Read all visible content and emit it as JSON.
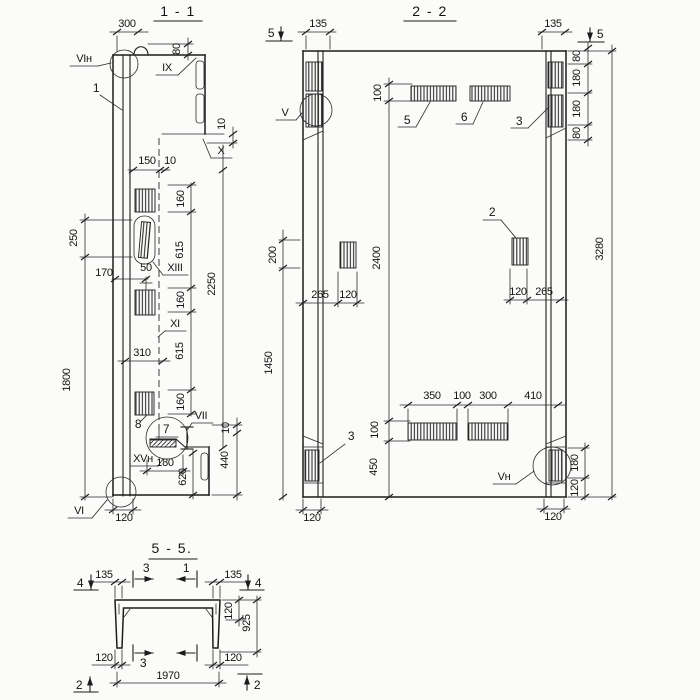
{
  "drawing": {
    "kind": "structural panel sections blueprint",
    "ink": "#1c1c1c",
    "paper": "#fbfbf9"
  },
  "s11": {
    "title": "1 - 1",
    "d300": "300",
    "d80": "80",
    "lblVIn": "VIн",
    "lblIX": "IX",
    "c1": "1",
    "d10tr": "10",
    "lblX": "X",
    "d150": "150",
    "d10t": "10",
    "d160a": "160",
    "d615a": "615",
    "lblXIII": "XIII",
    "d170": "170",
    "d50": "50",
    "d250": "250",
    "d160b": "160",
    "lblXI": "XI",
    "d615b": "615",
    "d310": "310",
    "d2250": "2250",
    "d1800": "1800",
    "d160c": "160",
    "c8": "8",
    "c7": "7",
    "lblVII": "VII",
    "d10br": "10",
    "d440": "440",
    "lblXVn": "XVн",
    "d180": "180",
    "d620": "620",
    "lblVI": "VI",
    "d120": "120"
  },
  "s22": {
    "title": "2 - 2",
    "m5l": "5",
    "d135l": "135",
    "lblV": "V",
    "d100t": "100",
    "c5": "5",
    "c6": "6",
    "c3t": "3",
    "d135r": "135",
    "m5r": "5",
    "d80a": "80",
    "d180a": "180",
    "d180b": "180",
    "d80b": "80",
    "d200": "200",
    "d1450": "1450",
    "d2400": "2400",
    "d3280": "3280",
    "c2": "2",
    "d265l": "265",
    "d120l": "120",
    "d120r": "120",
    "d265r": "265",
    "d350": "350",
    "d100m": "100",
    "d300": "300",
    "d410": "410",
    "d100b": "100",
    "d450": "450",
    "c3b": "3",
    "lblVn": "Vн",
    "d180br": "180",
    "d120br": "120",
    "d120bl": "120",
    "d120bb": "120"
  },
  "s55": {
    "title": "5 - 5.",
    "m4l": "4",
    "d135l": "135",
    "m3t": "3",
    "m1t": "1",
    "d135r": "135",
    "m4r": "4",
    "d120t": "120",
    "d925": "925",
    "d120bl": "120",
    "m3b": "3",
    "d120br": "120",
    "d1970": "1970",
    "m2l": "2",
    "m2r": "2"
  }
}
